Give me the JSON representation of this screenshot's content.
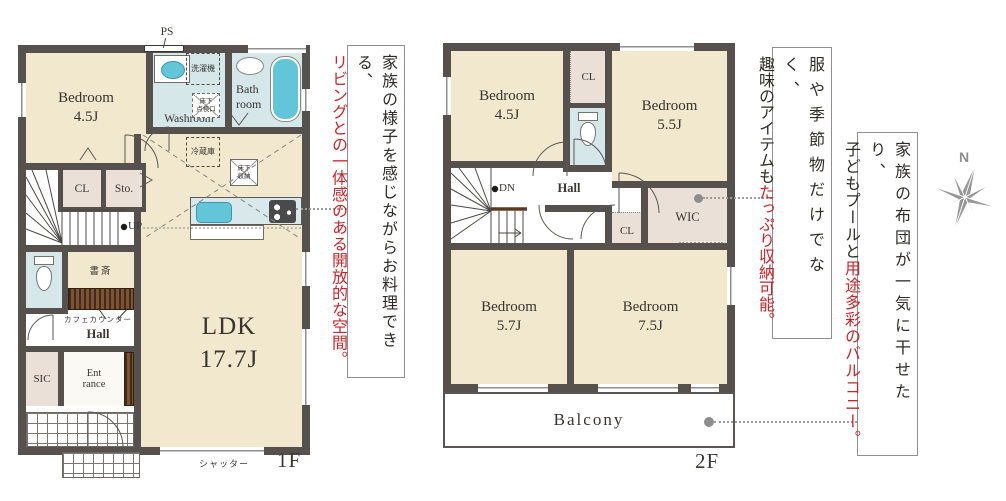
{
  "f1": {
    "label": "1F",
    "ps": "PS",
    "washer": "洗濯機",
    "washroom": "Washroom",
    "bath": [
      "Bath",
      "room"
    ],
    "hatch": [
      "床下",
      "点検口"
    ],
    "fridge": "冷蔵庫",
    "storage": [
      "床下",
      "収納"
    ],
    "bedroom": {
      "name": "Bedroom",
      "size": "4.5J"
    },
    "cl": "CL",
    "sto": "Sto.",
    "up": "UP",
    "study": "書斎",
    "cafe": "カフェカウンター",
    "hall": "Hall",
    "sic": "SIC",
    "ent": [
      "Ent",
      "rance"
    ],
    "ldk": {
      "name": "LDK",
      "size": "17.7J"
    },
    "shutter": "シャッター"
  },
  "f2": {
    "label": "2F",
    "b1": {
      "name": "Bedroom",
      "size": "4.5J"
    },
    "b2": {
      "name": "Bedroom",
      "size": "5.5J"
    },
    "b3": {
      "name": "Bedroom",
      "size": "5.7J"
    },
    "b4": {
      "name": "Bedroom",
      "size": "7.5J"
    },
    "cl1": "CL",
    "cl2": "CL",
    "wic": "WIC",
    "dn": "DN",
    "hall": "Hall",
    "balcony": "Balcony"
  },
  "notes": {
    "kitchen": {
      "black": "家族の様子を感じながらお料理できる、",
      "red": "リビングとの一体感のある開放的な空間。"
    },
    "storage": {
      "black1": "服や季節物だけでなく、",
      "black2": "趣味のアイテムも",
      "red": "たっぷり収納可能。"
    },
    "balcony": {
      "black1": "家族の布団が一気に干せたり、",
      "black2": "子どもプールと",
      "red": "用途多彩のバルコニー。"
    }
  },
  "compass": {
    "n": "N"
  },
  "colors": {
    "wall": "#57514e",
    "room_beige": "#f1e8ce",
    "closet_pink": "#ebe0d7",
    "wet_blue": "#d6e7ea",
    "fixture_teal": "#62c5d8",
    "wood_brown": "#5d3a22",
    "accent_red": "#c6262b",
    "text_dark": "#38342f",
    "connector_gray": "#9c9c9c",
    "compass_gray": "#8f8f8f"
  }
}
